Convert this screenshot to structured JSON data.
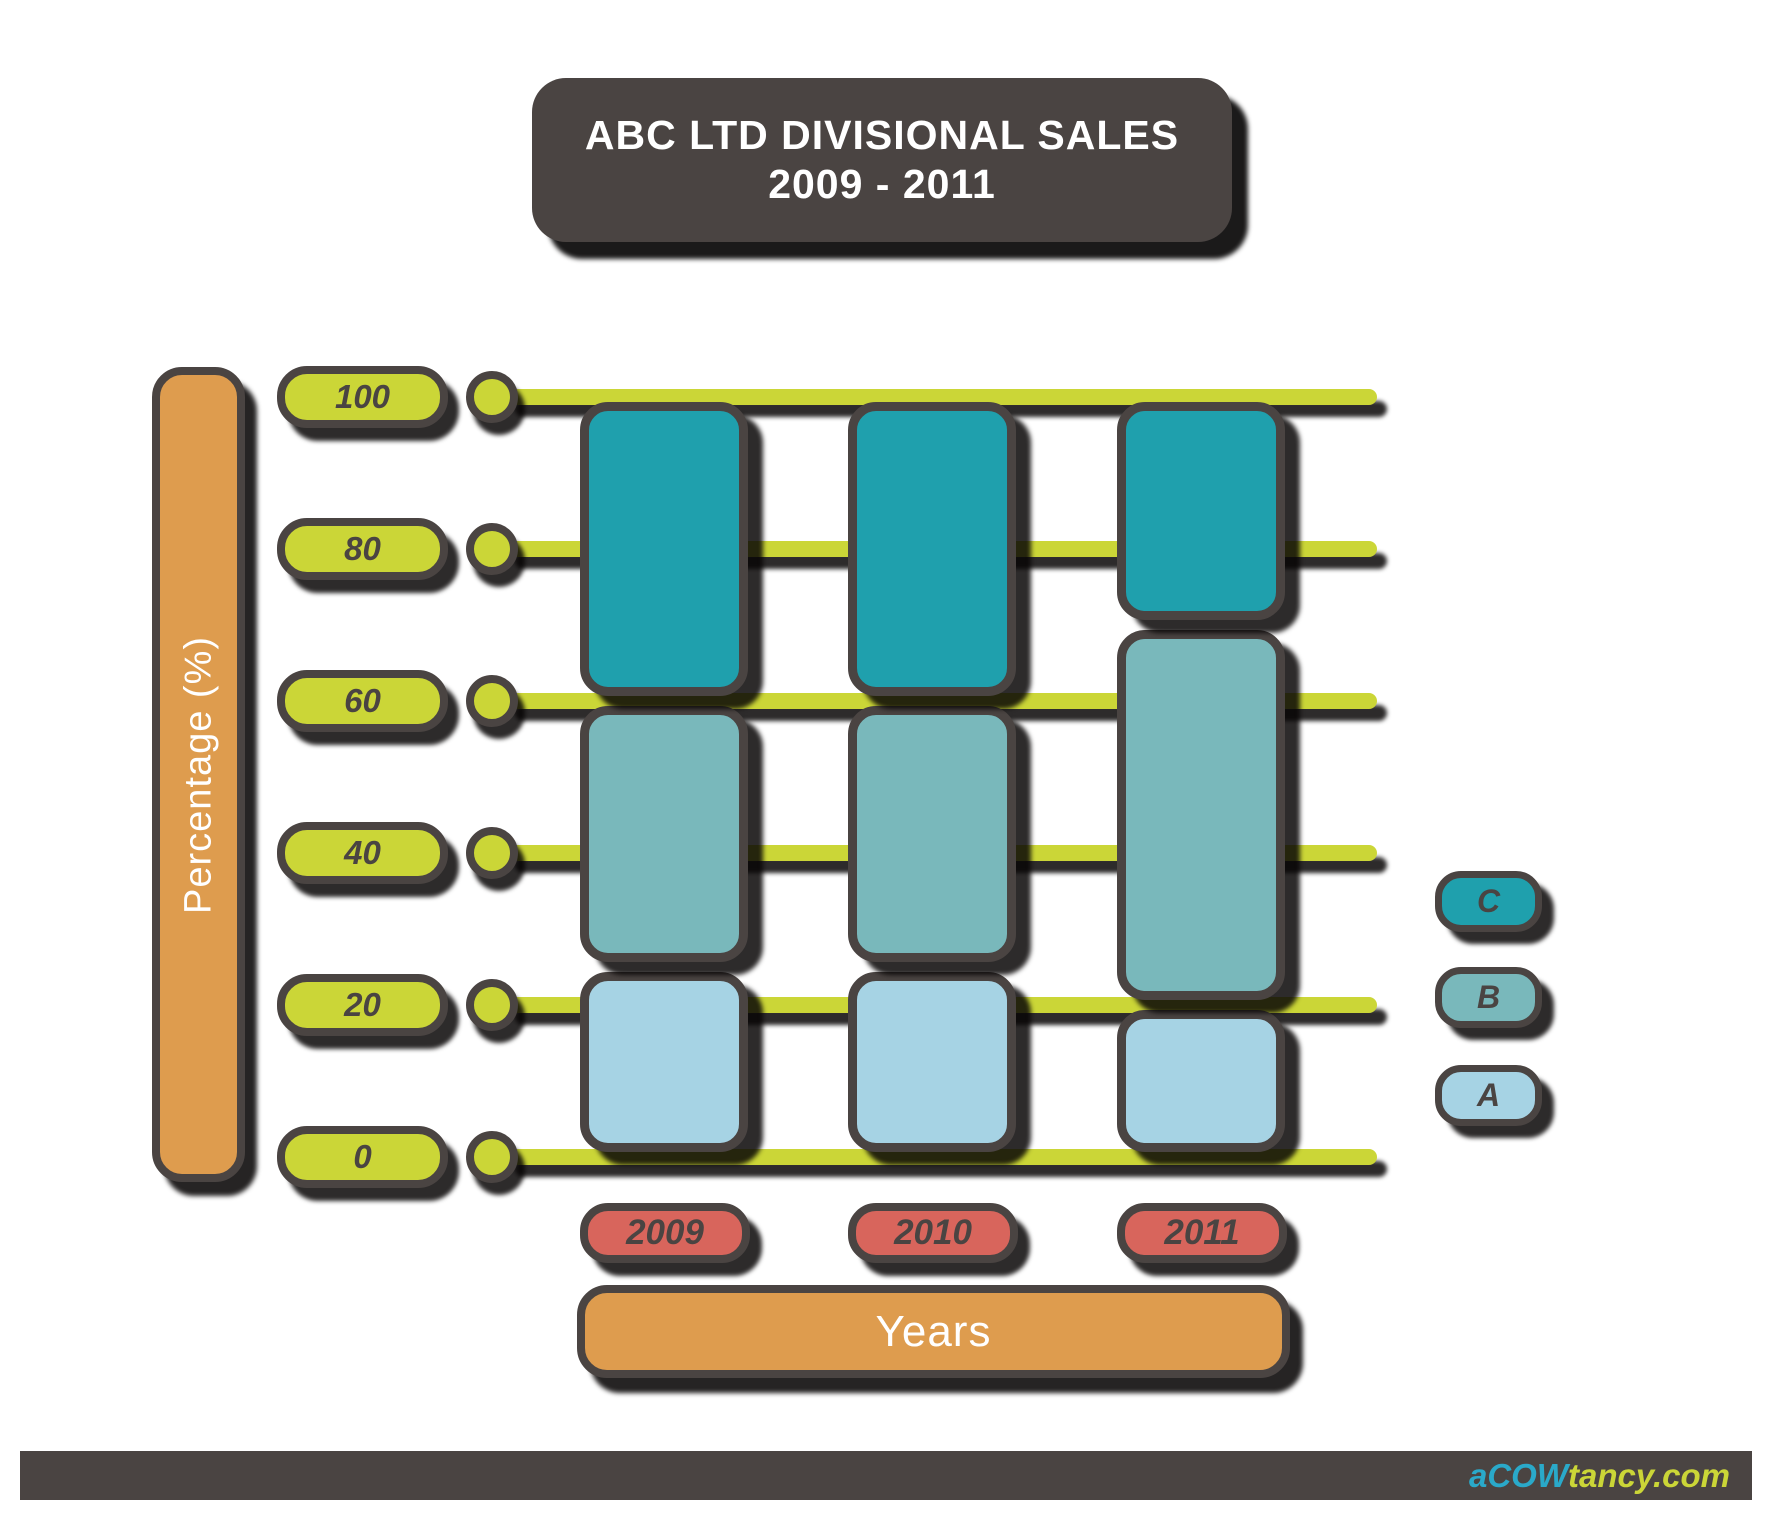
{
  "title": {
    "line1": "ABC LTD DIVISIONAL SALES",
    "line2": "2009 - 2011"
  },
  "y_axis": {
    "label": "Percentage (%)",
    "ticks": [
      "0",
      "20",
      "40",
      "60",
      "80",
      "100"
    ]
  },
  "x_axis": {
    "label": "Years",
    "categories": [
      "2009",
      "2010",
      "2011"
    ]
  },
  "legend": [
    {
      "label": "C",
      "color": "#1fa0ad"
    },
    {
      "label": "B",
      "color": "#79b8bb"
    },
    {
      "label": "A",
      "color": "#a6d3e4"
    }
  ],
  "footer": {
    "logo_prefix": "a",
    "logo_mid": "COW",
    "logo_suffix": "tancy.com"
  },
  "colors": {
    "dark": "#4a4442",
    "chartreuse": "#cbd637",
    "orange": "#de9c4e",
    "salmon": "#d8655c",
    "series_c": "#1fa0ad",
    "series_b": "#79b8bb",
    "series_a": "#a6d3e4",
    "logo_cyan": "#2aa9c9"
  },
  "chart_data": {
    "type": "bar",
    "stacked": true,
    "title": "ABC LTD DIVISIONAL SALES 2009 - 2011",
    "xlabel": "Years",
    "ylabel": "Percentage (%)",
    "categories": [
      "2009",
      "2010",
      "2011"
    ],
    "series": [
      {
        "name": "A",
        "color": "#a6d3e4",
        "values": [
          25,
          25,
          20
        ]
      },
      {
        "name": "B",
        "color": "#79b8bb",
        "values": [
          35,
          35,
          50
        ]
      },
      {
        "name": "C",
        "color": "#1fa0ad",
        "values": [
          40,
          40,
          30
        ]
      }
    ],
    "ylim": [
      0,
      100
    ],
    "yticks": [
      0,
      20,
      40,
      60,
      80,
      100
    ],
    "grid": true,
    "legend_position": "right",
    "source": "aCOWtancy.com"
  }
}
